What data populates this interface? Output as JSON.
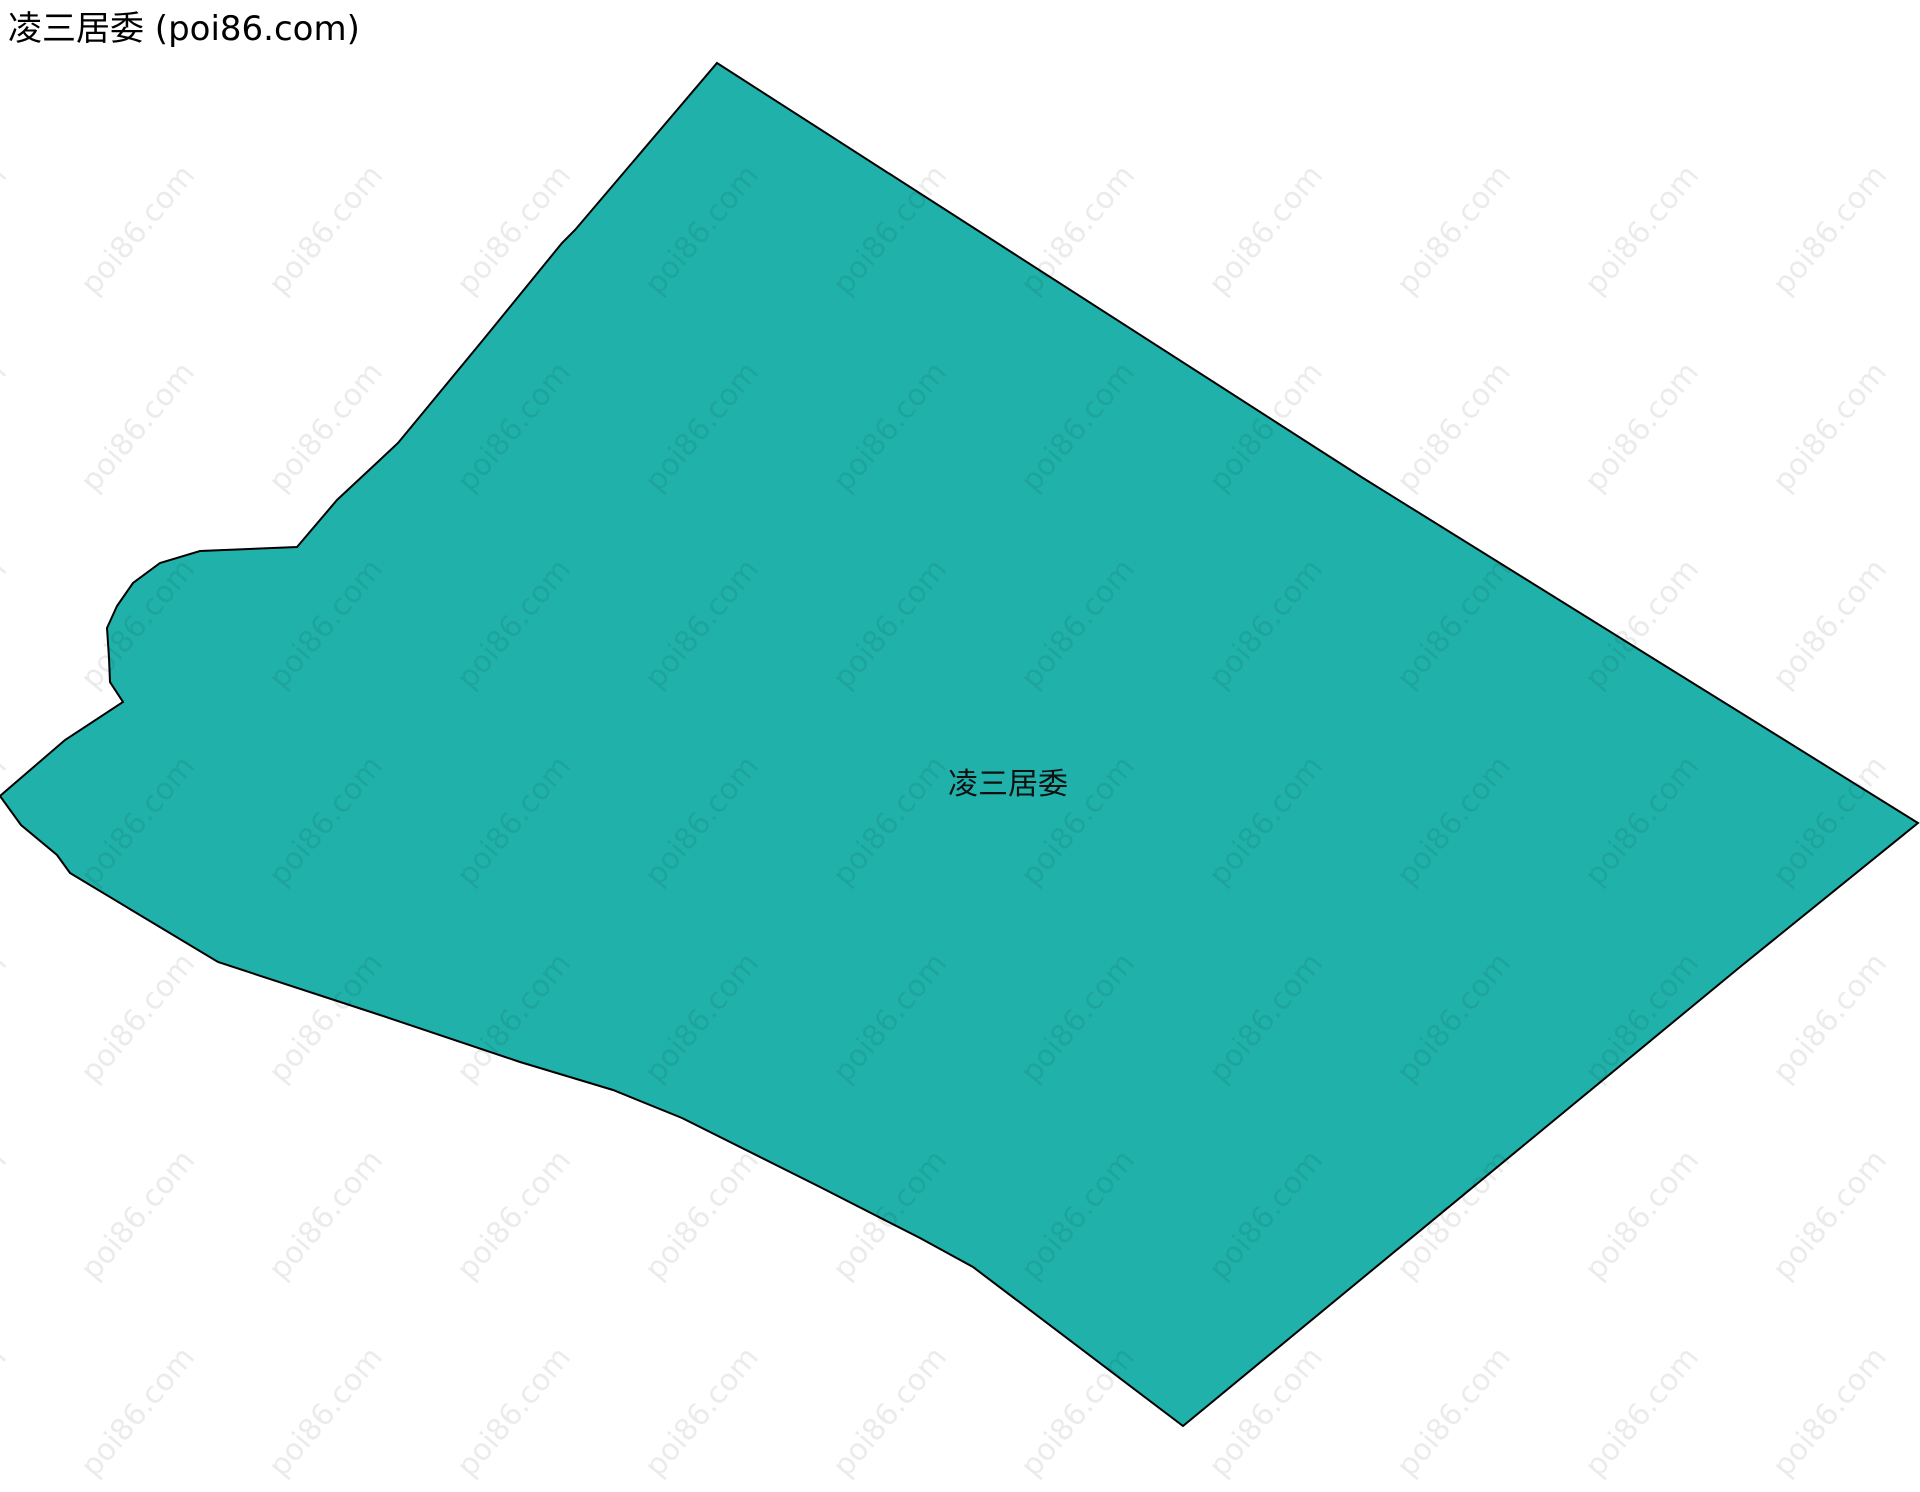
{
  "header": {
    "title": "凌三居委 (poi86.com)"
  },
  "map": {
    "label": "凌三居委",
    "label_position": {
      "x": 1008,
      "y": 781
    },
    "fill_color": "#20B2AA",
    "border_color": "#000000",
    "polygon_points": "717,63 1363,478 1918,823 1740,967 1183,1426 973,1267 920,1238 820,1187 790,1172 682,1118 613,1090 520,1062 380,1015 218,962 70,873 57,855 21,825 0,796 65,740 123,702 110,682 109,658 107,628 117,606 133,583 160,563 200,551 297,547 337,500 398,443 483,340 562,243 575,230"
  },
  "watermark": {
    "text": "poi86.com",
    "color": "rgba(0,0,0,0.08)"
  }
}
